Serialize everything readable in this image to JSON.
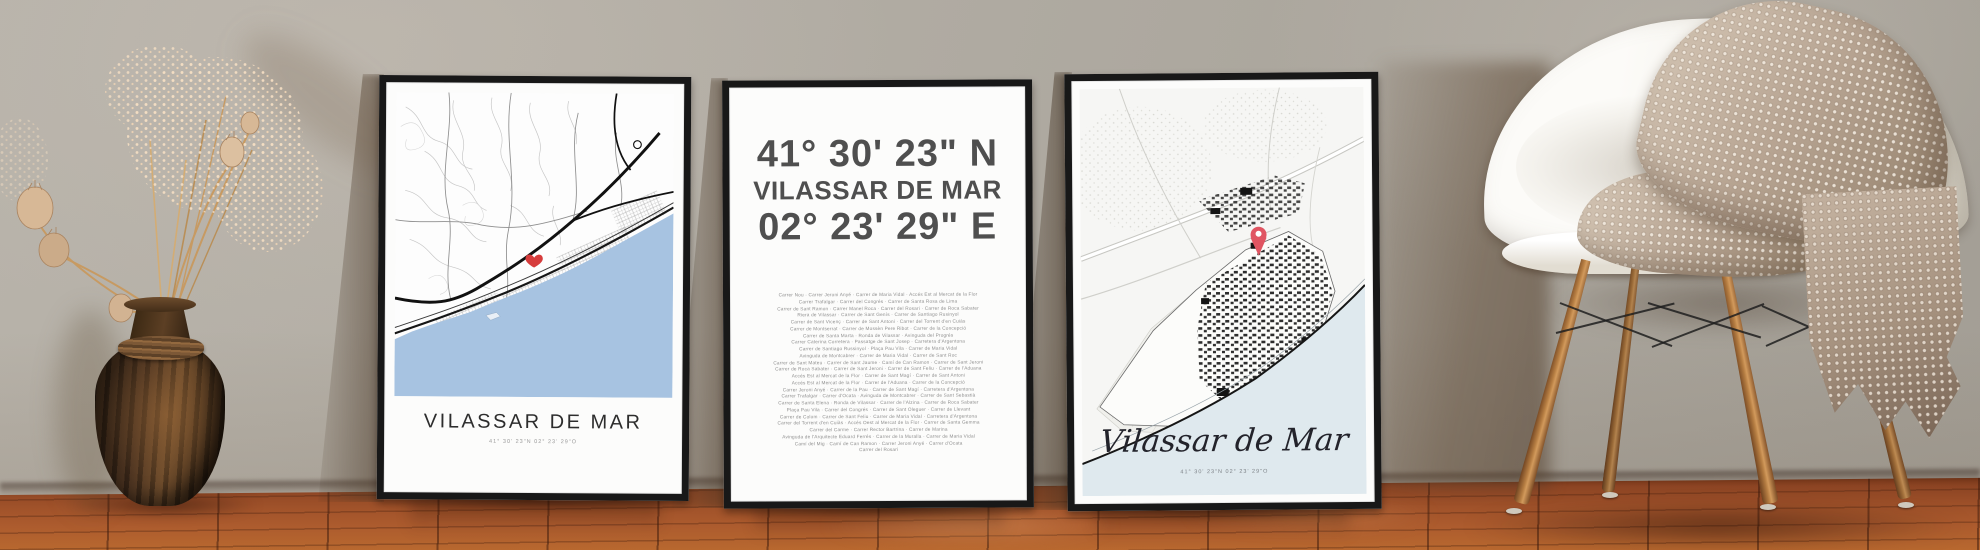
{
  "posters": {
    "left": {
      "title": "VILASSAR DE MAR",
      "coordinates": "41° 30' 23\"N 02° 23' 29\"O",
      "marker_icon": "heart-marker-icon",
      "marker_color": "#d63c3c",
      "sea_color": "#a7c3e1",
      "frame_color": "#181818"
    },
    "middle": {
      "latitude": "41° 30' 23\" N",
      "title": "VILASSAR DE MAR",
      "longitude": "02° 23' 29\" E",
      "headline_color": "#4f4f4f",
      "street_lines": [
        "Carrer Nou · Carrer Jeroni Anyé · Carrer de Maria Vidal · Accés Est al Mercat de la Flor",
        "Carrer Trafalgar · Carrer del Congrés · Carrer de Santa Rosa de Lima",
        "Carrer de Sant Ramon · Carrer Manel Roca · Carrer del Rosari · Carrer de Roca Sabater",
        "Riera de Vilassar · Carrer de Sant Genís · Carrer de Santiago Rusinyol",
        "Carrer de Sant Vicenç · Carrer de Sant Antoni · Carrer del Torrent d'en Cuiàs",
        "Carrer de Montserrat · Carrer de Mossèn Pere Ribot · Carrer de la Concepció",
        "Carrer de Santa Marta · Ronda de Vilassar · Avinguda del Progrés",
        "Carrer Caterina Corretera · Passatge de Sant Josep · Carretera d'Argentona",
        "Carrer de Santiago Russinyol · Plaça Pau Vila · Carrer de Maria Vidal",
        "Avinguda de Montcabrer · Carrer de Maria Vidal · Carrer de Sant Roc",
        "Carrer de Sant Mateu · Carrer de Sant Jaume · Camí de Can Ramon · Carrer de Sant Jeroni",
        "Carrer de Roca Sabater · Carrer de Sant Jeroni · Carrer de Sant Feliu · Carrer de l'Aduana",
        "Accés Est al Mercat de la Flor · Carrer de Sant Magí · Carrer de Sant Antoni",
        "Accés Est al Mercat de la Flor · Carrer de l'Aduana · Carrer de la Concepció",
        "Carrer Jeroni Anyé · Carrer de la Pau · Carrer de Sant Magí · Carretera d'Argentona",
        "Carrer Trafalgar · Carrer d'Ocata · Avinguda de Montcabrer · Carrer de Sant Sebastià",
        "Carrer de Santa Elena · Ronda de Vilassar · Carrer de l'Alzina · Carrer de Roca Sabater",
        "Plaça Pau Vila · Carrer del Congrés · Carrer de Sant Oleguer · Carrer de Llevant",
        "Carrer de Colom · Carrer de Sant Feliu · Carrer de Maria Vidal · Carretera d'Argentona",
        "Carrer del Torrent d'en Cuiàs · Accés Oest al Mercat de la Flor · Carrer de Santa Gemma",
        "Carrer del Carme · Carrer Rector Bartrina · Carrer de Marina",
        "Avinguda de l'Arquitecte Eduard Ferrés · Carrer de la Muralla · Carrer de Maria Vidal",
        "Camí del Mig · Camí de Can Ramon · Carrer Jeroni Anyé · Carrer d'Ocata",
        "Carrer del Rosari"
      ]
    },
    "right": {
      "title": "Vilassar de Mar",
      "coordinates": "41° 30' 23\"N 02° 23' 29\"O",
      "marker_icon": "location-pin-icon",
      "marker_color": "#e05562",
      "sea_color": "#dfe9ee",
      "frame_color": "#181818"
    }
  },
  "palette": {
    "wall": "#b0aba2",
    "floor_wood": "#a0522a",
    "chair_shell": "#f6f3ec",
    "blanket": "#b9a795",
    "chair_legs": "#a8713c",
    "vase": "#4d3520",
    "dried_flowers": "#ecd3b2"
  }
}
